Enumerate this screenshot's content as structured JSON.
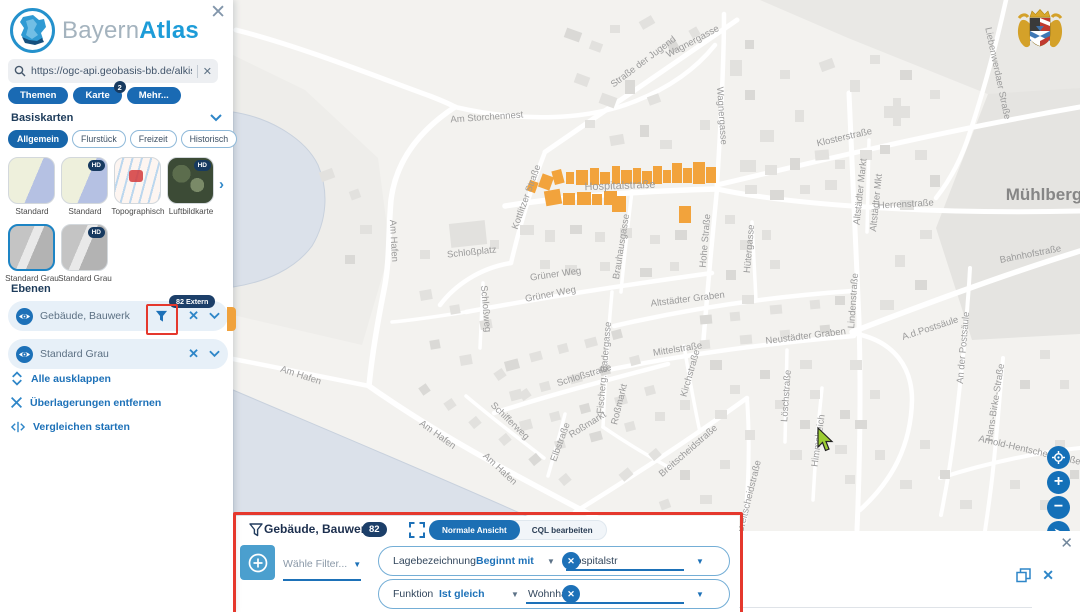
{
  "brand": {
    "gray": "Bayern",
    "blue": "Atlas"
  },
  "window": {
    "close": "✕"
  },
  "search": {
    "value": "https://ogc-api.geobasis-bb.de/alkis-verein",
    "clear": "✕"
  },
  "tabs": [
    {
      "label": "Themen"
    },
    {
      "label": "Karte",
      "badge": "2"
    },
    {
      "label": "Mehr..."
    }
  ],
  "basemaps": {
    "title": "Basiskarten",
    "chips": [
      "Allgemein",
      "Flurstück",
      "Freizeit",
      "Historisch"
    ],
    "thumbs": [
      {
        "label": "Standard"
      },
      {
        "label": "Standard",
        "hd": "HD"
      },
      {
        "label": "Topographisch"
      },
      {
        "label": "Luftbildkarte",
        "hd": "HD"
      },
      {
        "label": "Standard Grau"
      },
      {
        "label": "Standard Grau",
        "hd": "HD"
      }
    ]
  },
  "layers": {
    "title": "Ebenen",
    "rows": [
      {
        "name": "Gebäude, Bauwerk",
        "badge": "82 Extern"
      },
      {
        "name": "Standard Grau"
      }
    ]
  },
  "actions": [
    {
      "label": "Alle ausklappen"
    },
    {
      "label": "Überlagerungen entfernen"
    },
    {
      "label": "Vergleichen starten"
    }
  ],
  "filter_panel": {
    "title": "Gebäude, Bauwerk",
    "count": "82",
    "views": [
      {
        "label": "Normale Ansicht"
      },
      {
        "label": "CQL bearbeiten"
      }
    ],
    "select_placeholder": "Wähle Filter...",
    "rows": [
      {
        "field": "Lagebezeichnung",
        "op": "Beginnt mit",
        "value": "Hospitalstr"
      },
      {
        "field": "Funktion",
        "op": "Ist gleich",
        "value": "Wohnhaus"
      }
    ]
  },
  "map": {
    "labels": [
      {
        "t": "Am Storchennest",
        "x": 487,
        "y": 120,
        "r": -4
      },
      {
        "t": "Straße der Jugend",
        "x": 645,
        "y": 64,
        "r": -37
      },
      {
        "t": "Wagnergasse",
        "x": 694,
        "y": 44,
        "r": -28
      },
      {
        "t": "Wagnergasse",
        "x": 719,
        "y": 116,
        "r": 86
      },
      {
        "t": "Klosterstraße",
        "x": 845,
        "y": 140,
        "r": -13
      },
      {
        "t": "Herrenstraße",
        "x": 906,
        "y": 207,
        "r": -3
      },
      {
        "t": "Altstädter Markt",
        "x": 863,
        "y": 192,
        "r": -84
      },
      {
        "t": "Altstädter Mkt",
        "x": 879,
        "y": 203,
        "r": -84
      },
      {
        "t": "Liebenwerdaer Straße",
        "x": 995,
        "y": 74,
        "r": 78
      },
      {
        "t": "Mühlberg",
        "x": 1044,
        "y": 200,
        "r": 0,
        "s": 17,
        "c": "#868686",
        "w": 600
      },
      {
        "t": "Hospitalstraße",
        "x": 620,
        "y": 189,
        "r": -2,
        "s": 11
      },
      {
        "t": "Kottlitzer Straße",
        "x": 529,
        "y": 198,
        "r": -70
      },
      {
        "t": "Schloßplatz",
        "x": 472,
        "y": 255,
        "r": -6
      },
      {
        "t": "Am Hafen",
        "x": 391,
        "y": 241,
        "r": 87
      },
      {
        "t": "Grüner Weg",
        "x": 556,
        "y": 277,
        "r": -8
      },
      {
        "t": "Grüner Weg",
        "x": 551,
        "y": 297,
        "r": -11
      },
      {
        "t": "Hohe Straße",
        "x": 708,
        "y": 241,
        "r": -85
      },
      {
        "t": "Hütergasse",
        "x": 752,
        "y": 249,
        "r": -85
      },
      {
        "t": "Brauhausgasse",
        "x": 624,
        "y": 247,
        "r": -81
      },
      {
        "t": "Altstädter Graben",
        "x": 688,
        "y": 302,
        "r": -7
      },
      {
        "t": "Neustädter Graben",
        "x": 806,
        "y": 339,
        "r": -7
      },
      {
        "t": "Mittelstraße",
        "x": 678,
        "y": 352,
        "r": -9
      },
      {
        "t": "Lindenstraße",
        "x": 856,
        "y": 301,
        "r": -86
      },
      {
        "t": "Bahnhofstraße",
        "x": 1031,
        "y": 257,
        "r": -11
      },
      {
        "t": "A.d.Postsäule",
        "x": 931,
        "y": 331,
        "r": -18
      },
      {
        "t": "An der Postsäule",
        "x": 966,
        "y": 348,
        "r": -85
      },
      {
        "t": "Schloßstraße",
        "x": 585,
        "y": 378,
        "r": -17
      },
      {
        "t": "Schloßweg",
        "x": 483,
        "y": 309,
        "r": 85
      },
      {
        "t": "Fischerg. Badergasse",
        "x": 607,
        "y": 368,
        "r": -85
      },
      {
        "t": "Roßmarkt",
        "x": 589,
        "y": 427,
        "r": -32
      },
      {
        "t": "Roßmarkt",
        "x": 622,
        "y": 405,
        "r": -76
      },
      {
        "t": "Kirchstraße",
        "x": 693,
        "y": 374,
        "r": -74
      },
      {
        "t": "Löschstraße",
        "x": 789,
        "y": 396,
        "r": -86
      },
      {
        "t": "Breitscheidstraße",
        "x": 690,
        "y": 453,
        "r": -41
      },
      {
        "t": "Breitscheidstraße",
        "x": 752,
        "y": 497,
        "r": -76
      },
      {
        "t": "Elbstraße",
        "x": 563,
        "y": 443,
        "r": -70
      },
      {
        "t": "Schifferweg",
        "x": 508,
        "y": 423,
        "r": 44
      },
      {
        "t": "Am Hafen",
        "x": 300,
        "y": 378,
        "r": 18
      },
      {
        "t": "Am Hafen",
        "x": 436,
        "y": 437,
        "r": 36
      },
      {
        "t": "Am Hafen",
        "x": 498,
        "y": 471,
        "r": 43
      },
      {
        "t": "Himmelreich",
        "x": 821,
        "y": 441,
        "r": -82
      },
      {
        "t": "Hans-Birke-Straße",
        "x": 998,
        "y": 403,
        "r": -81
      },
      {
        "t": "Arnold-Hentschel-Straße",
        "x": 1029,
        "y": 453,
        "r": 13
      }
    ]
  },
  "colors": {
    "accent": "#1d71b8",
    "badge": "#1c3f69",
    "highlight": "#f2a33c",
    "annotation": "#e5382d",
    "water": "#dbe1ea"
  }
}
